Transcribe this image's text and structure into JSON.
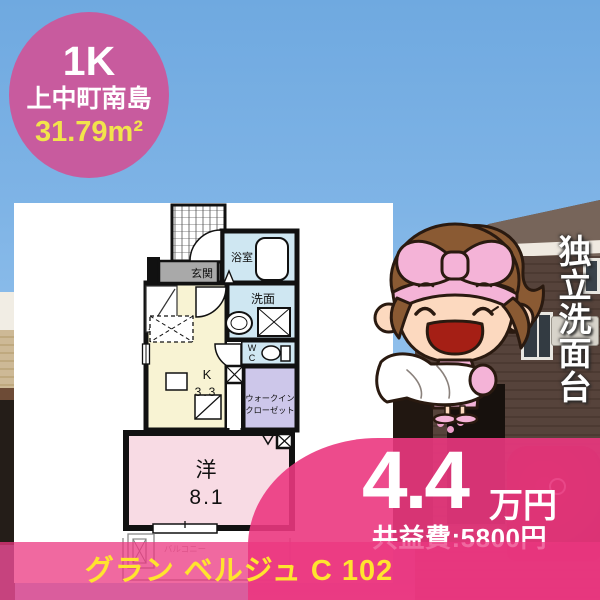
{
  "badge": {
    "layout_type": "1K",
    "location": "上中町南島",
    "area": "31.79m²"
  },
  "floor_plan": {
    "genkan": "玄関",
    "bathroom": "浴室",
    "washroom": "洗面",
    "wc_line1": "W",
    "wc_line2": "C",
    "kitchen_label": "K",
    "kitchen_size": "3.3",
    "closet_line1": "ウォークイン",
    "closet_line2": "クローゼット",
    "room_label": "洋",
    "room_size": "8.1",
    "balcony": "バルコニー"
  },
  "feature": {
    "vertical_text": "独立洗面台"
  },
  "price": {
    "rent": "4.4",
    "rent_unit": "万円",
    "fee": "共益費:5800円"
  },
  "footer": {
    "property_name": "グラン ベルジュ C 102"
  },
  "colors": {
    "badge_pink": "#c85b9e",
    "overlay_pink": "#eb3780",
    "highlight_yellow": "#ffe42e",
    "area_yellow": "#f2e44b",
    "room_pink": "#f8dbe4",
    "kitchen_yellow": "#f8f3d3",
    "wet_area_blue": "#cfe7f2",
    "closet_lavender": "#cdc7ea"
  }
}
